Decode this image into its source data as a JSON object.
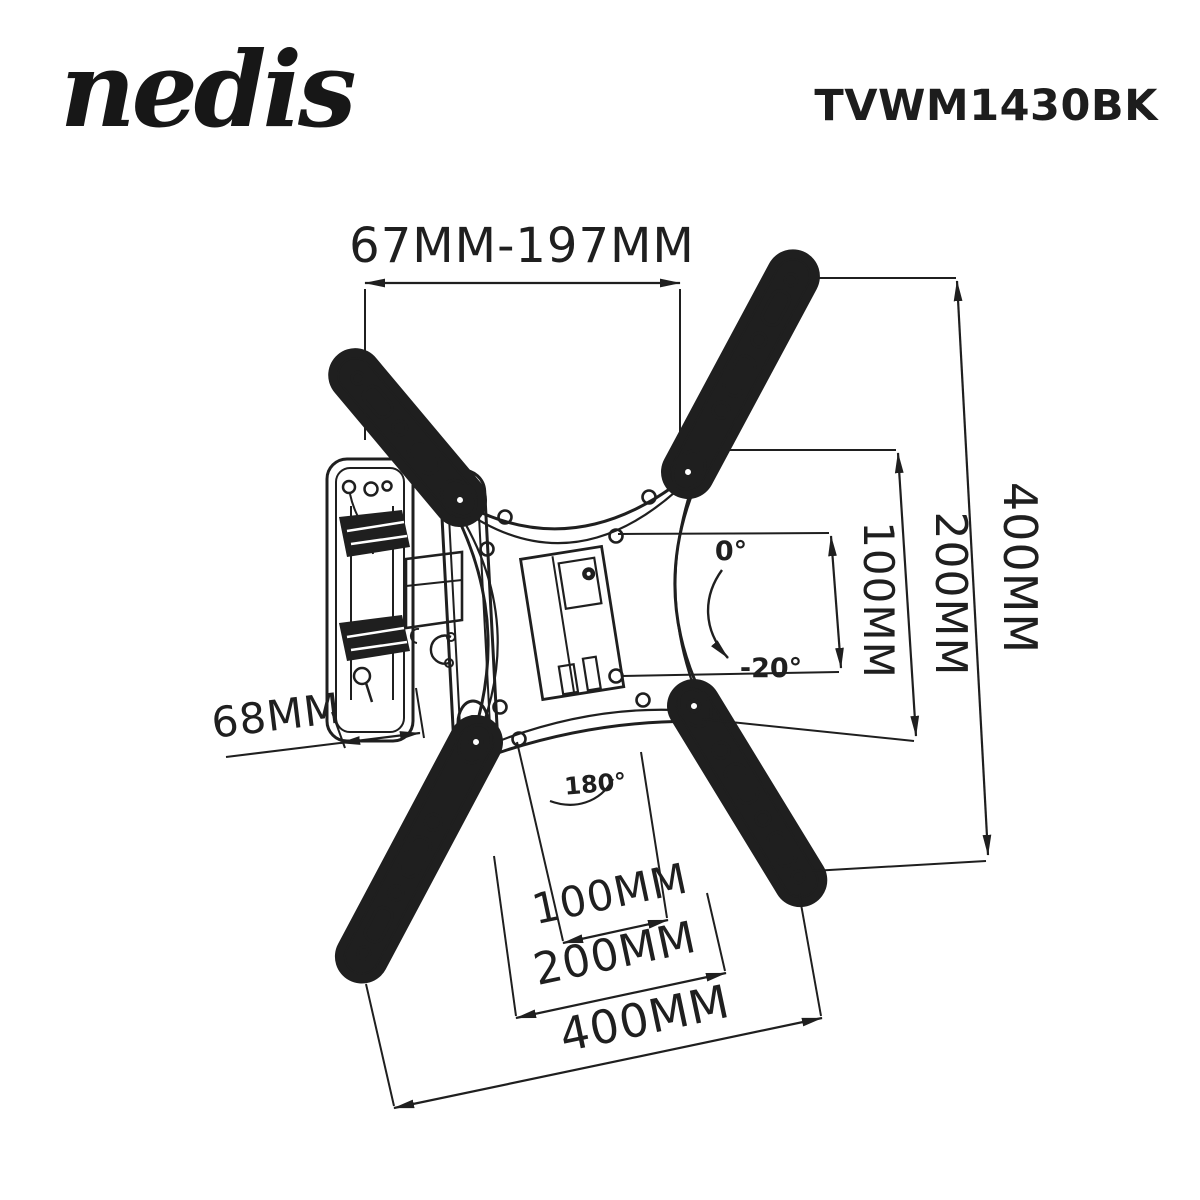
{
  "page": {
    "background": "#ffffff",
    "line_color": "#1f1f1f"
  },
  "header": {
    "brand": "nedis",
    "model": "TVWM1430BK"
  },
  "diagram": {
    "type": "technical-line-drawing",
    "subject": "Full-motion TV wall mount with X-shaped VESA arms, wall plate and articulating arm",
    "dimensions": {
      "top_extension_range": "67MM-197MM",
      "right_vertical": [
        "100MM",
        "200MM",
        "400MM"
      ],
      "bottom_horizontal": [
        "100MM",
        "200MM",
        "400MM"
      ],
      "wall_plate_depth": "68MM"
    },
    "angles": {
      "tilt_from": "0°",
      "tilt_to": "-20°",
      "swivel": "180°"
    }
  },
  "labels": {
    "dim_top": "67MM-197MM",
    "dim_right_100": "100MM",
    "dim_right_200": "200MM",
    "dim_right_400": "400MM",
    "dim_bottom_100": "100MM",
    "dim_bottom_200": "200MM",
    "dim_bottom_400": "400MM",
    "dim_depth": "68MM",
    "angle_tilt_start": "0°",
    "angle_tilt_end": "-20°",
    "angle_swivel": "180°"
  }
}
